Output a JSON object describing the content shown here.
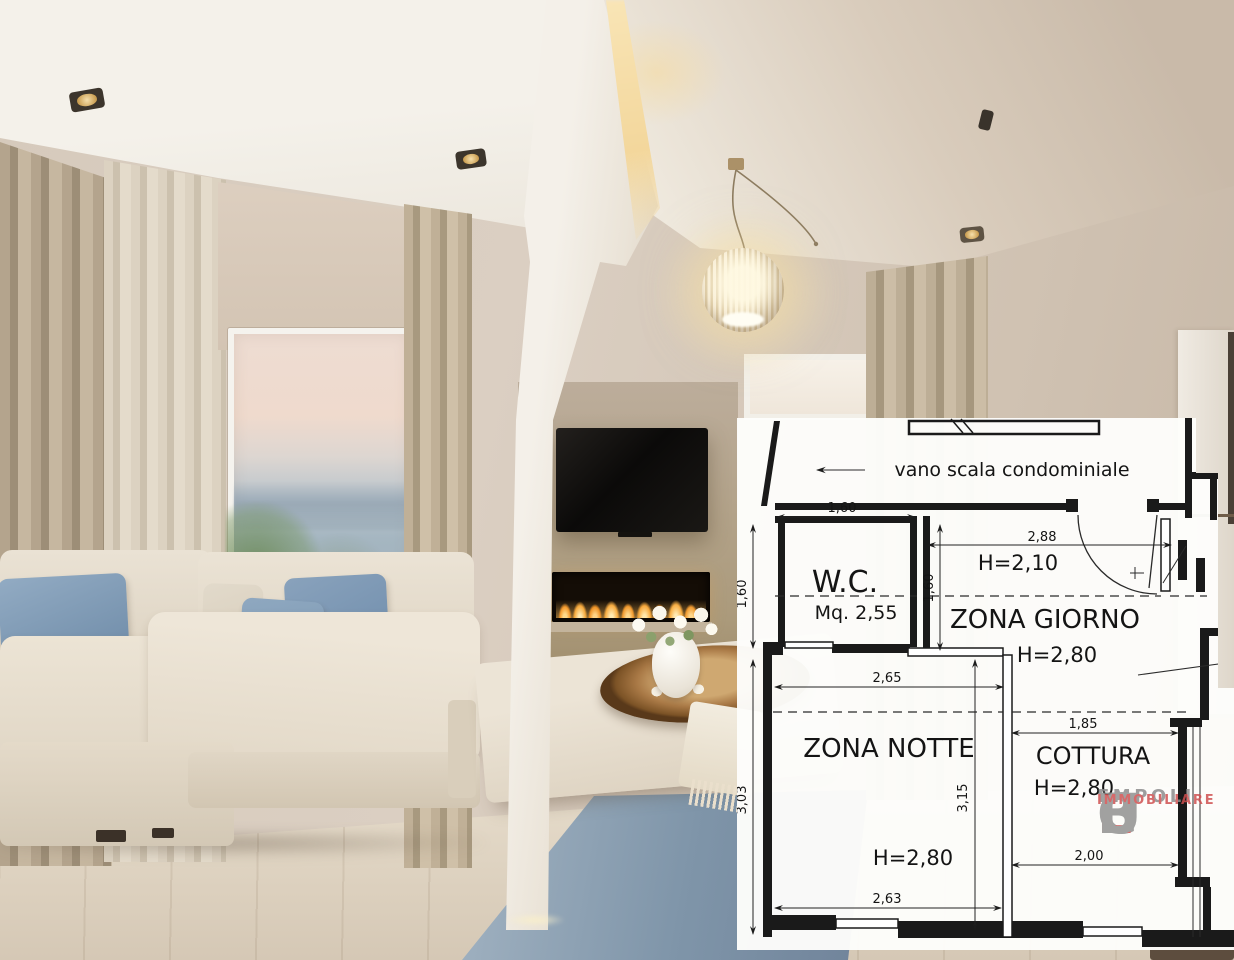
{
  "scene": {
    "type": "interior-living-room-photo",
    "objects": [
      "ceiling-spotlights",
      "led-cove-beam",
      "white-column",
      "pendant-lamp",
      "curtain-panels",
      "sheer-curtains",
      "roller-blind",
      "window-sunset-view",
      "wall-mounted-tv",
      "linear-fireplace",
      "modular-sofa",
      "blue-cushions",
      "ottoman-bench",
      "wood-tray",
      "vase-white-roses",
      "throw-blanket",
      "blue-area-rug",
      "light-wood-floor"
    ],
    "colors": {
      "wall": "#d6cabc",
      "ceiling": "#f4f1ea",
      "ceiling_soffit": "#c9baa9",
      "curtain": "#b4a48d",
      "sofa": "#eae2d4",
      "cushion_blue": "#7b98b3",
      "rug_blue": "#8a9fb2",
      "floor_wood": "#ddd1be",
      "flame": "#f6a93c",
      "lamp_glow": "#f6de a0"
    }
  },
  "floorplan": {
    "bg": "#fdfdfb",
    "line": "#1a1a1a",
    "corridor_label": "vano scala condominiale",
    "rooms": {
      "wc": {
        "name": "W.C.",
        "area": "Mq. 2,55"
      },
      "giorno": {
        "name": "ZONA GIORNO",
        "h_main": "H=2,80",
        "h_low": "H=2,10"
      },
      "notte": {
        "name": "ZONA NOTTE",
        "h": "H=2,80"
      },
      "cottura": {
        "name": "COTTURA",
        "h": "H=2,80"
      }
    },
    "dims": {
      "wc_top": "1,60",
      "wc_left": "1,60",
      "giorno_left": "1,60",
      "giorno_width": "2,88",
      "notte_top": "2,65",
      "notte_left": "3,03",
      "notte_mid": "3,15",
      "notte_bottom": "2,63",
      "cottura_top": "1,85",
      "cottura_bottom": "2,00"
    },
    "logo": {
      "top": "EMPOLI",
      "c": "C",
      "l": "L",
      "u": "U",
      "b": "B",
      "bottom": "IMMOBILIARE",
      "gray": "#909090",
      "red": "#d04f4f"
    }
  }
}
